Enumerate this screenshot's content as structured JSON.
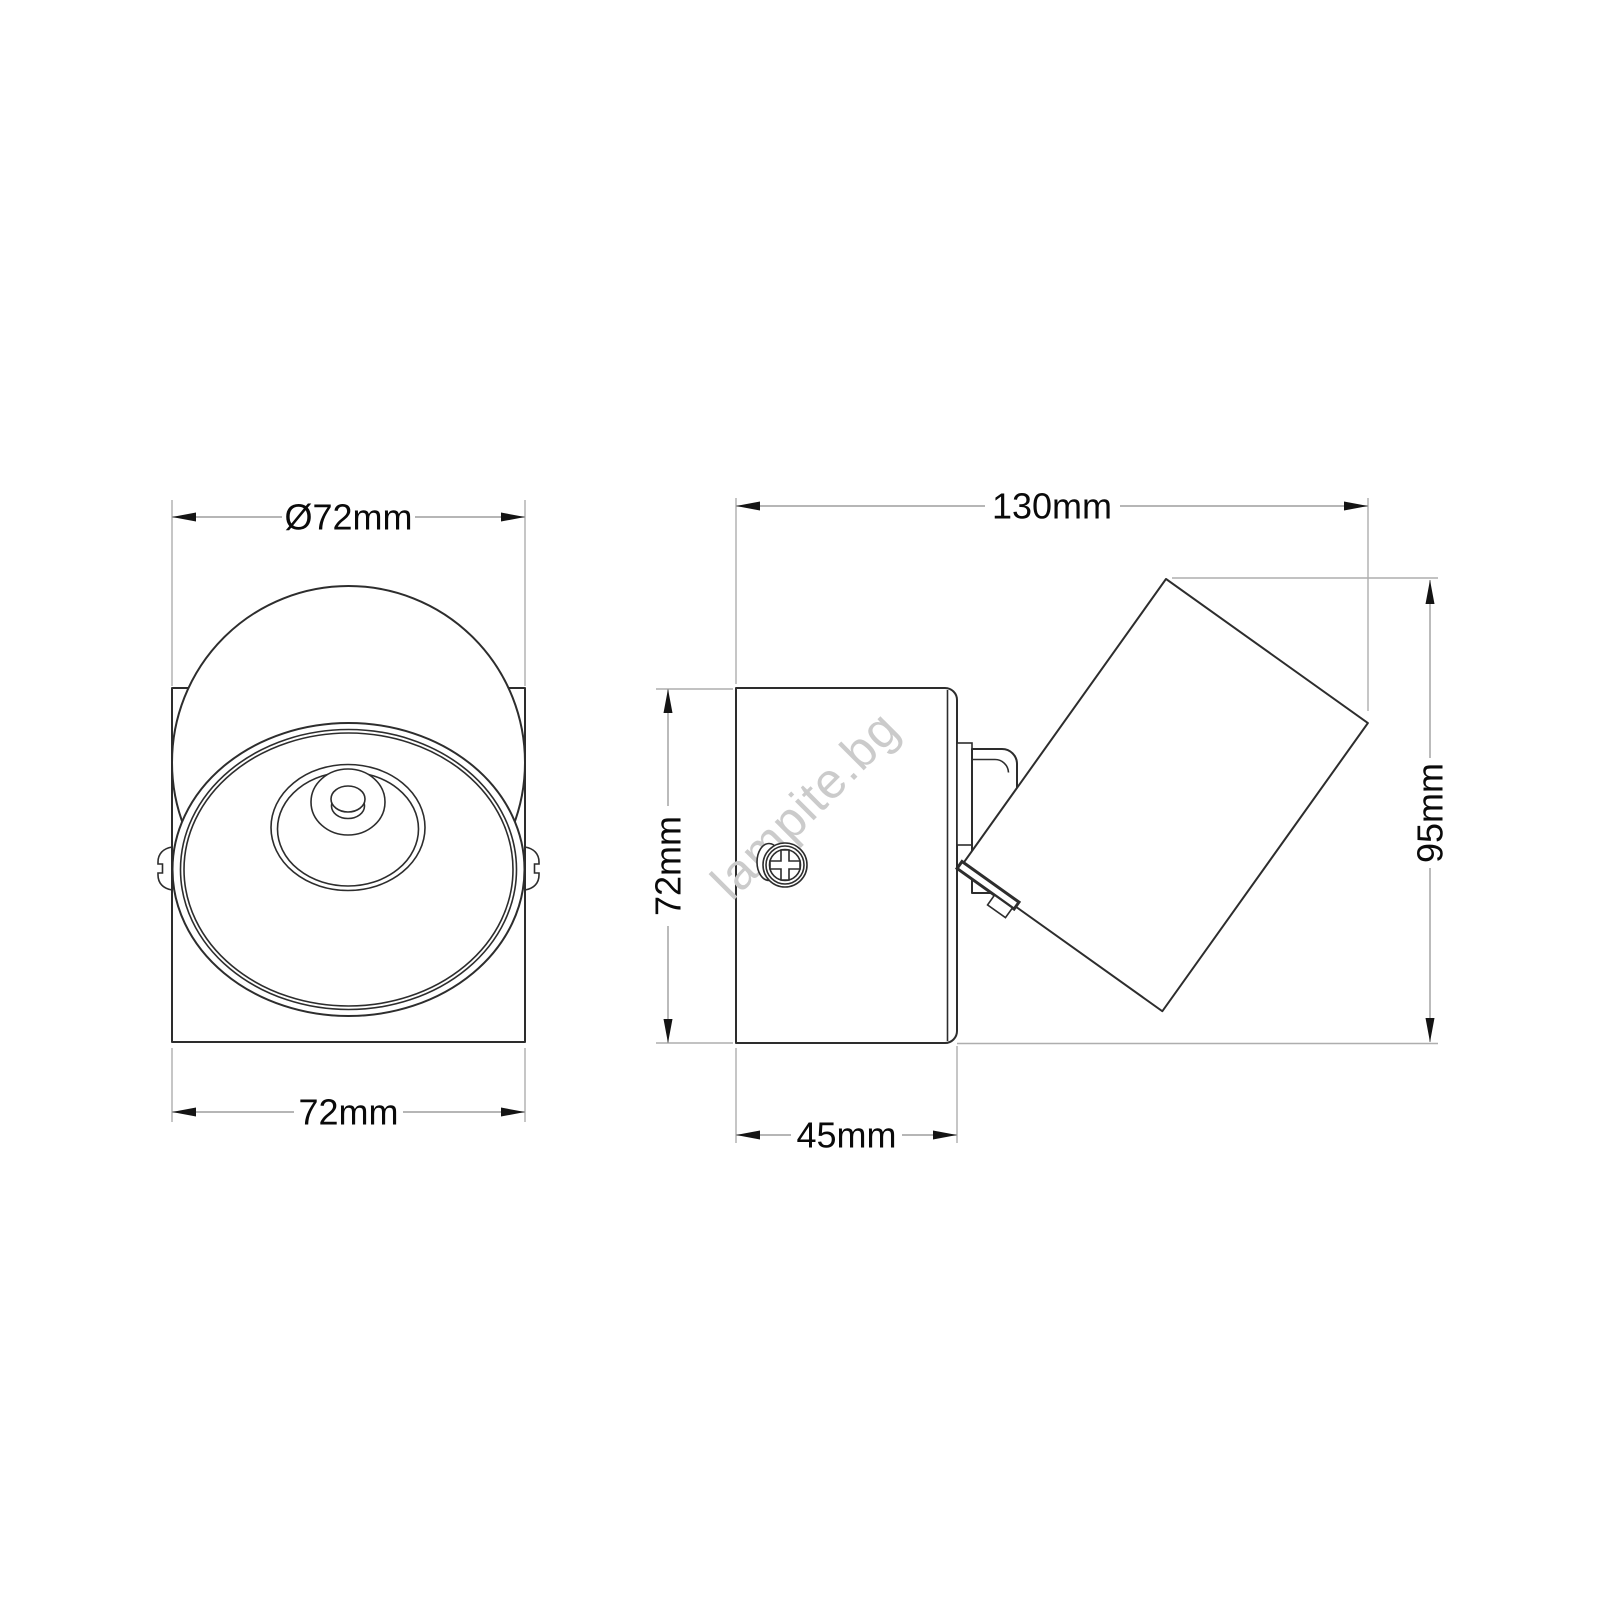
{
  "drawing": {
    "watermark": "lampite.bg",
    "front_view": {
      "diameter_label": "Ø72mm",
      "width_label": "72mm"
    },
    "side_view": {
      "width_label": "130mm",
      "body_height_label": "72mm",
      "overall_height_label": "95mm",
      "depth_label": "45mm"
    },
    "colors": {
      "background": "#ffffff",
      "outline": "#2d2d2d",
      "dimension-line": "#9e9e9e",
      "extension-line": "#aeaeae",
      "arrow": "#141414",
      "label": "#0a0a0a",
      "watermark": "#cbcbcb"
    }
  }
}
